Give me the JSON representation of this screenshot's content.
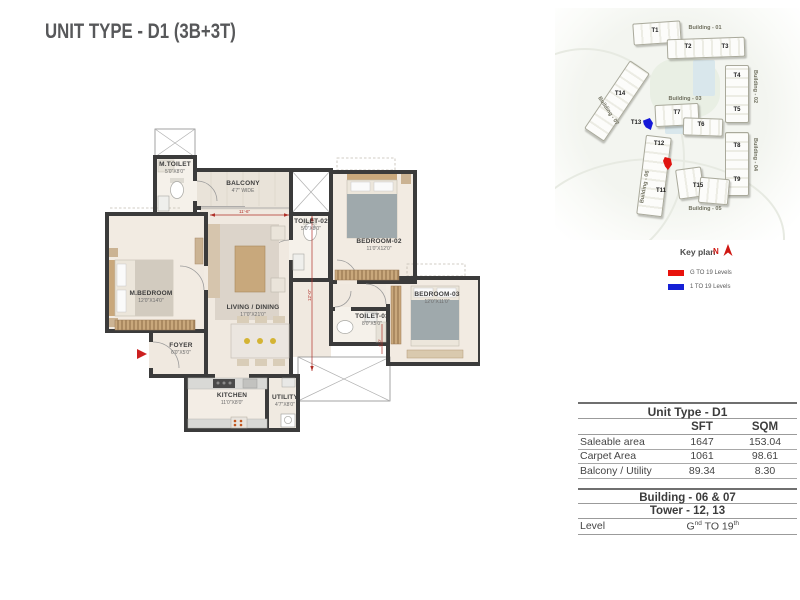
{
  "page": {
    "title": "UNIT TYPE - D1 (3B+3T)"
  },
  "floorplan": {
    "rooms": [
      {
        "name": "M.TOILET",
        "dim": "5'0\"X8'0\""
      },
      {
        "name": "BALCONY",
        "dim": "4'7\" WIDE"
      },
      {
        "name": "TOILET-02",
        "dim": "5'0\"X8'0\""
      },
      {
        "name": "BEDROOM-02",
        "dim": "11'0\"X12'0\""
      },
      {
        "name": "M.BEDROOM",
        "dim": "12'0\"X14'0\""
      },
      {
        "name": "LIVING / DINING",
        "dim": "17'0\"X21'0\""
      },
      {
        "name": "FOYER",
        "dim": "6'0\"X5'0\""
      },
      {
        "name": "TOILET-03",
        "dim": "8'0\"X5'0\""
      },
      {
        "name": "BEDROOM-03",
        "dim": "12'0\"X11'0\""
      },
      {
        "name": "KITCHEN",
        "dim": "11'0\"X8'0\""
      },
      {
        "name": "UTILITY",
        "dim": "4'7\"X8'0\""
      }
    ],
    "dims": {
      "h": "11'-6\"",
      "v": "12'-0\"",
      "s": "4'-0\""
    }
  },
  "keyplan": {
    "title": "Key plan",
    "north": "N",
    "buildings": [
      {
        "label": "Building - 01"
      },
      {
        "label": "Building - 02"
      },
      {
        "label": "Building - 03"
      },
      {
        "label": "Building - 04"
      },
      {
        "label": "Building - 05"
      },
      {
        "label": "Building - 06"
      },
      {
        "label": "Building - 07"
      }
    ],
    "towers": [
      "T1",
      "T2",
      "T3",
      "T4",
      "T5",
      "T6",
      "T7",
      "T8",
      "T9",
      "T11",
      "T12",
      "T13",
      "T14",
      "T15"
    ],
    "legend": [
      {
        "swatch": "#e8120c",
        "label": "G  TO 19 Levels"
      },
      {
        "swatch": "#1520d6",
        "label": "1 TO 19 Levels"
      }
    ]
  },
  "spec_table": {
    "title": "Unit Type - D1",
    "col_sft": "SFT",
    "col_sqm": "SQM",
    "rows": [
      {
        "label": "Saleable area",
        "sft": "1647",
        "sqm": "153.04"
      },
      {
        "label": "Carpet Area",
        "sft": "1061",
        "sqm": "98.61"
      },
      {
        "label": "Balcony / Utility",
        "sft": "89.34",
        "sqm": "8.30"
      }
    ],
    "building": "Building - 06 & 07",
    "tower": "Tower - 12, 13",
    "level": {
      "label": "Level",
      "base1": "G",
      "sup1": "nd",
      "base2": " TO 19",
      "sup2": "th"
    }
  }
}
